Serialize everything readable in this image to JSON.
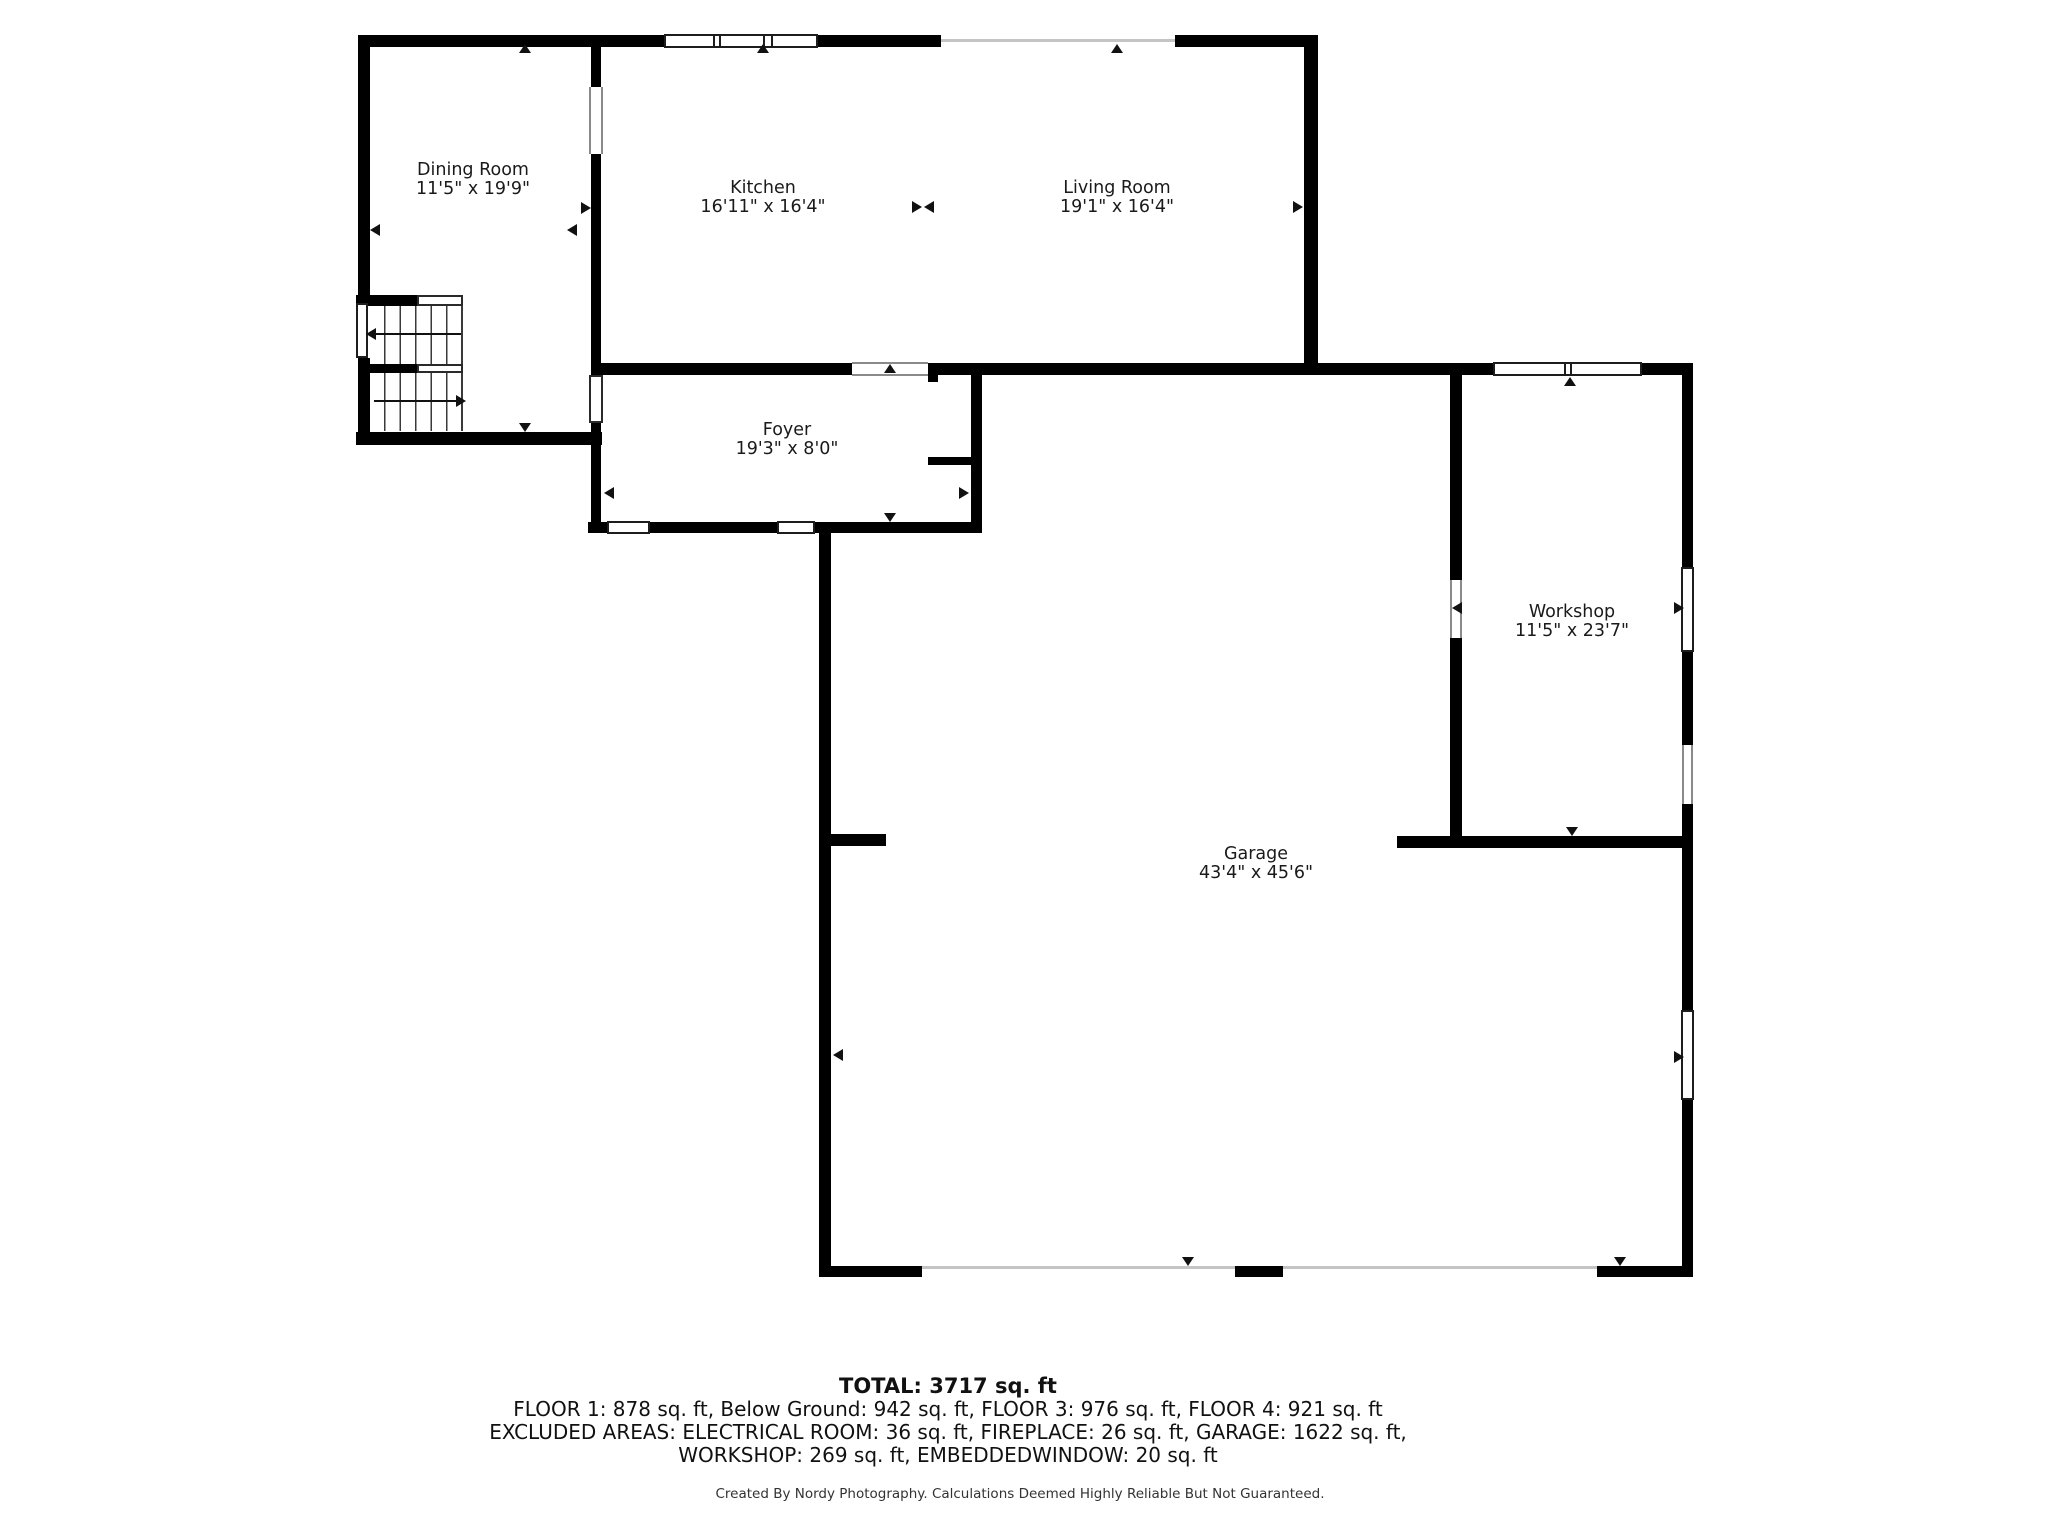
{
  "floorplan": {
    "rooms": [
      {
        "name": "Dining Room",
        "dims": "11'5\" x 19'9\""
      },
      {
        "name": "Kitchen",
        "dims": "16'11\" x 16'4\""
      },
      {
        "name": "Living Room",
        "dims": "19'1\" x 16'4\""
      },
      {
        "name": "Foyer",
        "dims": "19'3\" x 8'0\""
      },
      {
        "name": "Workshop",
        "dims": "11'5\" x 23'7\""
      },
      {
        "name": "Garage",
        "dims": "43'4\" x 45'6\""
      }
    ],
    "summary": {
      "total": "TOTAL: 3717 sq. ft",
      "line1": "FLOOR 1: 878 sq. ft, Below Ground: 942 sq. ft, FLOOR 3: 976 sq. ft, FLOOR 4: 921 sq. ft",
      "line2": "EXCLUDED AREAS: ELECTRICAL ROOM: 36 sq. ft, FIREPLACE: 26 sq. ft, GARAGE: 1622 sq. ft,",
      "line3": "WORKSHOP: 269 sq. ft, EMBEDDEDWINDOW: 20 sq. ft"
    },
    "credit": "Created By Nordy Photography. Calculations Deemed Highly Reliable But Not Guaranteed.",
    "colors": {
      "wall": "#000000",
      "background": "#ffffff",
      "thin_line": "#c4c4c4",
      "text": "#1a1a1a"
    }
  }
}
